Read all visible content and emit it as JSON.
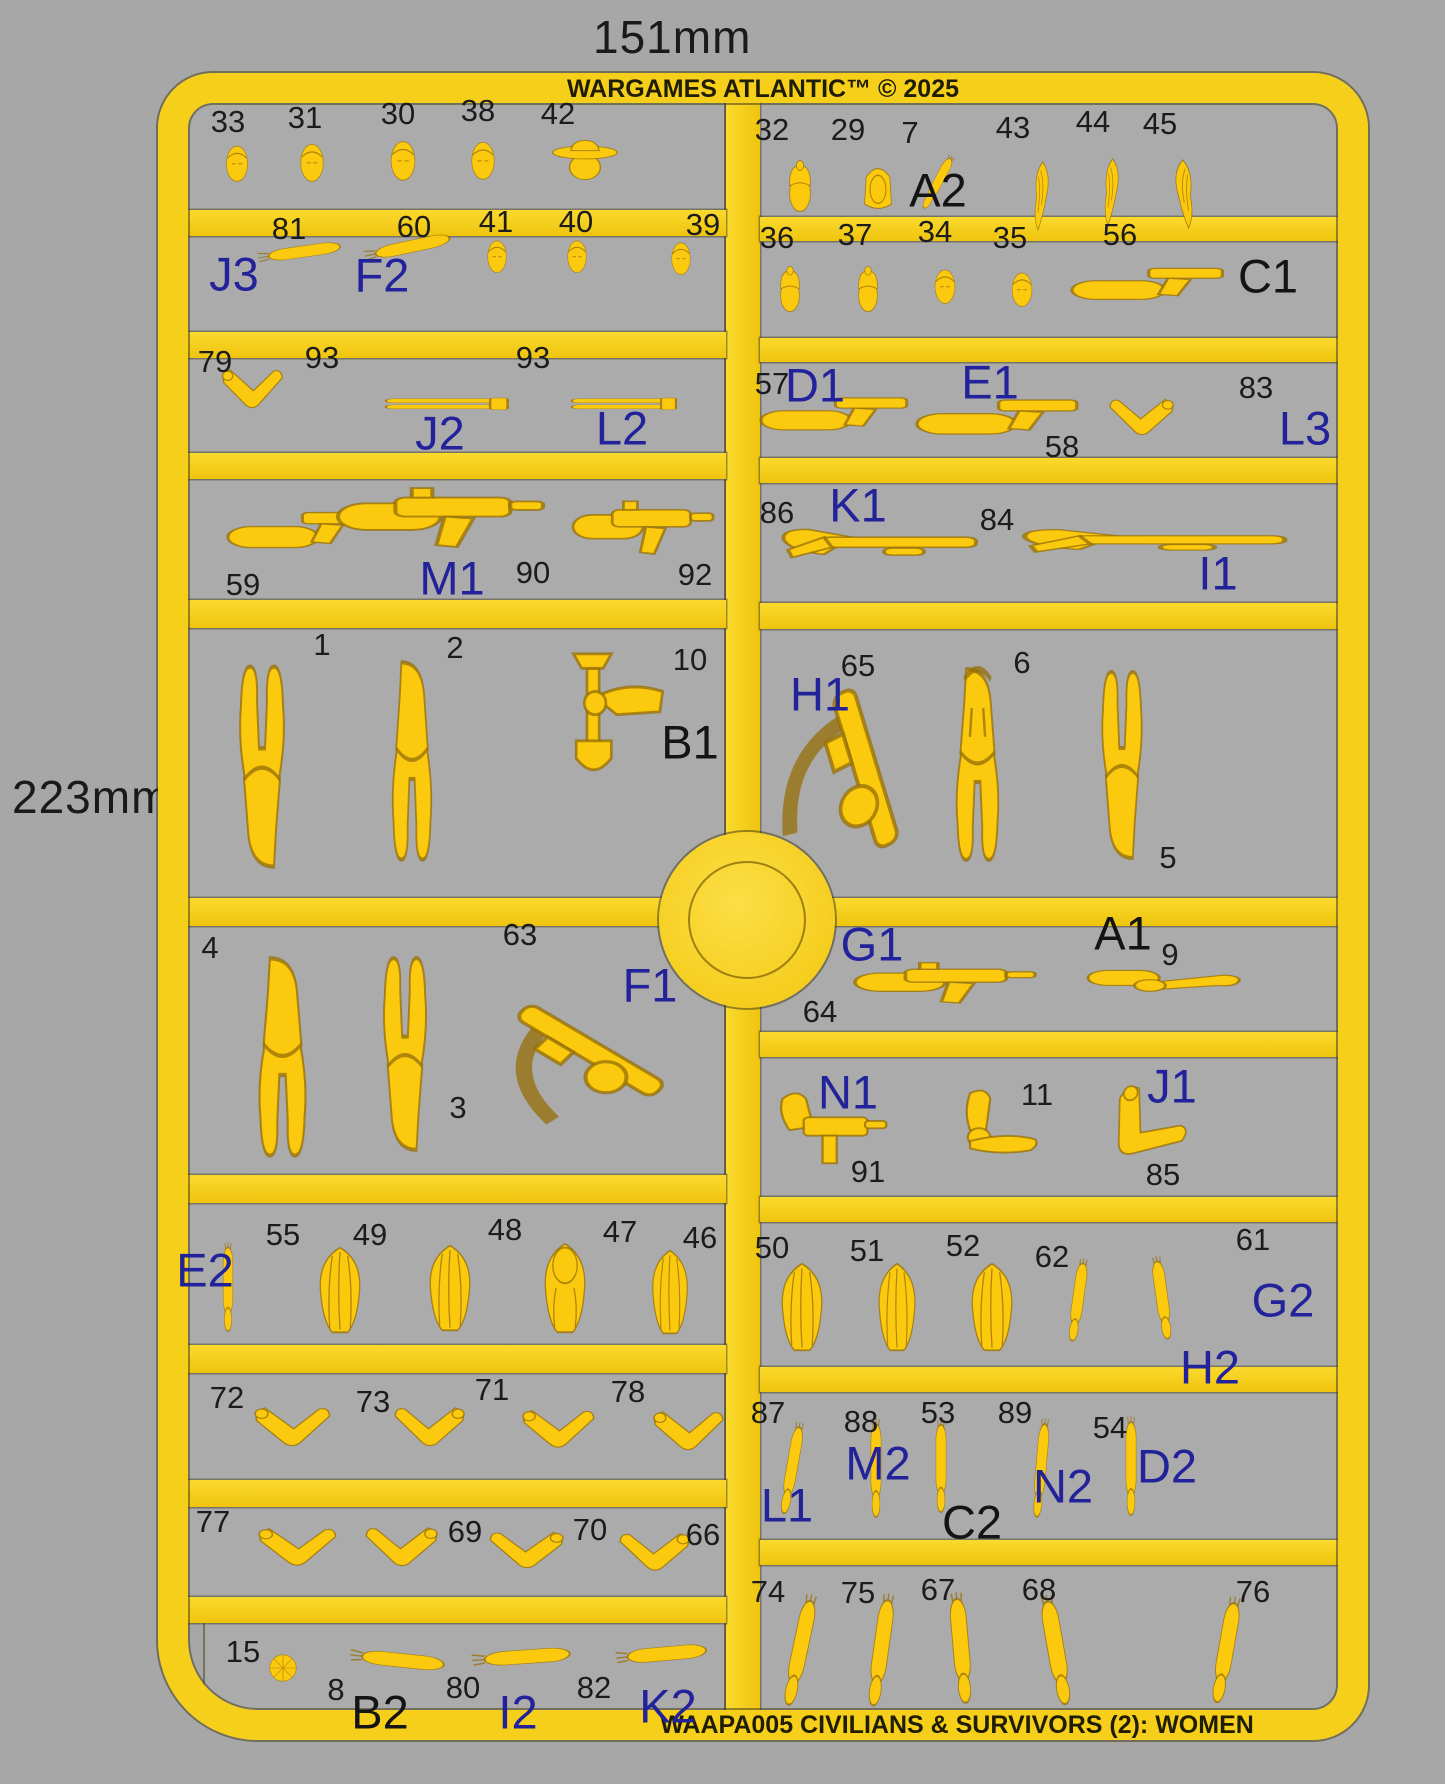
{
  "meta": {
    "width_label": "151mm",
    "height_label": "223mm",
    "brand": "WARGAMES ATLANTIC™ © 2025",
    "product": "WAAPA005 CIVILIANS & SURVIVORS (2): WOMEN"
  },
  "colors": {
    "background": "#a7a7a7",
    "sprue_yellow": "#f6cf1a",
    "part_yellow": "#fbc90d",
    "group_blue": "#22229a",
    "text_black": "#1c1c1c"
  },
  "labels": [
    {
      "t": "33",
      "x": 228,
      "y": 122,
      "k": "num"
    },
    {
      "t": "31",
      "x": 305,
      "y": 118,
      "k": "num"
    },
    {
      "t": "30",
      "x": 398,
      "y": 114,
      "k": "num"
    },
    {
      "t": "38",
      "x": 478,
      "y": 111,
      "k": "num"
    },
    {
      "t": "42",
      "x": 558,
      "y": 114,
      "k": "num"
    },
    {
      "t": "81",
      "x": 289,
      "y": 229,
      "k": "num"
    },
    {
      "t": "60",
      "x": 414,
      "y": 227,
      "k": "num"
    },
    {
      "t": "41",
      "x": 496,
      "y": 222,
      "k": "num"
    },
    {
      "t": "40",
      "x": 576,
      "y": 222,
      "k": "num"
    },
    {
      "t": "39",
      "x": 703,
      "y": 225,
      "k": "num"
    },
    {
      "t": "J3",
      "x": 234,
      "y": 274,
      "k": "blue"
    },
    {
      "t": "F2",
      "x": 382,
      "y": 275,
      "k": "blue"
    },
    {
      "t": "79",
      "x": 215,
      "y": 362,
      "k": "num"
    },
    {
      "t": "93",
      "x": 322,
      "y": 358,
      "k": "num"
    },
    {
      "t": "93",
      "x": 533,
      "y": 358,
      "k": "num"
    },
    {
      "t": "J2",
      "x": 440,
      "y": 433,
      "k": "blue"
    },
    {
      "t": "L2",
      "x": 622,
      "y": 428,
      "k": "blue"
    },
    {
      "t": "59",
      "x": 243,
      "y": 585,
      "k": "num"
    },
    {
      "t": "90",
      "x": 533,
      "y": 573,
      "k": "num"
    },
    {
      "t": "92",
      "x": 695,
      "y": 575,
      "k": "num"
    },
    {
      "t": "M1",
      "x": 452,
      "y": 578,
      "k": "blue"
    },
    {
      "t": "1",
      "x": 322,
      "y": 645,
      "k": "num"
    },
    {
      "t": "2",
      "x": 455,
      "y": 648,
      "k": "num"
    },
    {
      "t": "10",
      "x": 690,
      "y": 660,
      "k": "num"
    },
    {
      "t": "B1",
      "x": 690,
      "y": 742,
      "k": "black"
    },
    {
      "t": "4",
      "x": 210,
      "y": 948,
      "k": "num"
    },
    {
      "t": "3",
      "x": 458,
      "y": 1108,
      "k": "num"
    },
    {
      "t": "63",
      "x": 520,
      "y": 935,
      "k": "num"
    },
    {
      "t": "F1",
      "x": 650,
      "y": 985,
      "k": "blue"
    },
    {
      "t": "E2",
      "x": 205,
      "y": 1270,
      "k": "blue"
    },
    {
      "t": "55",
      "x": 283,
      "y": 1235,
      "k": "num"
    },
    {
      "t": "49",
      "x": 370,
      "y": 1235,
      "k": "num"
    },
    {
      "t": "48",
      "x": 505,
      "y": 1230,
      "k": "num"
    },
    {
      "t": "47",
      "x": 620,
      "y": 1232,
      "k": "num"
    },
    {
      "t": "46",
      "x": 700,
      "y": 1238,
      "k": "num"
    },
    {
      "t": "72",
      "x": 227,
      "y": 1398,
      "k": "num"
    },
    {
      "t": "73",
      "x": 373,
      "y": 1402,
      "k": "num"
    },
    {
      "t": "71",
      "x": 492,
      "y": 1390,
      "k": "num"
    },
    {
      "t": "78",
      "x": 628,
      "y": 1392,
      "k": "num"
    },
    {
      "t": "77",
      "x": 213,
      "y": 1522,
      "k": "num"
    },
    {
      "t": "69",
      "x": 465,
      "y": 1532,
      "k": "num"
    },
    {
      "t": "70",
      "x": 590,
      "y": 1530,
      "k": "num"
    },
    {
      "t": "66",
      "x": 703,
      "y": 1535,
      "k": "num"
    },
    {
      "t": "15",
      "x": 243,
      "y": 1652,
      "k": "num"
    },
    {
      "t": "8",
      "x": 336,
      "y": 1690,
      "k": "num"
    },
    {
      "t": "80",
      "x": 463,
      "y": 1688,
      "k": "num"
    },
    {
      "t": "82",
      "x": 594,
      "y": 1688,
      "k": "num"
    },
    {
      "t": "B2",
      "x": 380,
      "y": 1712,
      "k": "black"
    },
    {
      "t": "I2",
      "x": 518,
      "y": 1712,
      "k": "blue"
    },
    {
      "t": "K2",
      "x": 668,
      "y": 1706,
      "k": "blue"
    },
    {
      "t": "32",
      "x": 772,
      "y": 130,
      "k": "num"
    },
    {
      "t": "29",
      "x": 848,
      "y": 130,
      "k": "num"
    },
    {
      "t": "7",
      "x": 910,
      "y": 133,
      "k": "num"
    },
    {
      "t": "43",
      "x": 1013,
      "y": 128,
      "k": "num"
    },
    {
      "t": "44",
      "x": 1093,
      "y": 122,
      "k": "num"
    },
    {
      "t": "45",
      "x": 1160,
      "y": 124,
      "k": "num"
    },
    {
      "t": "A2",
      "x": 938,
      "y": 190,
      "k": "black"
    },
    {
      "t": "36",
      "x": 777,
      "y": 238,
      "k": "num"
    },
    {
      "t": "37",
      "x": 855,
      "y": 235,
      "k": "num"
    },
    {
      "t": "34",
      "x": 935,
      "y": 232,
      "k": "num"
    },
    {
      "t": "35",
      "x": 1010,
      "y": 238,
      "k": "num"
    },
    {
      "t": "56",
      "x": 1120,
      "y": 235,
      "k": "num"
    },
    {
      "t": "C1",
      "x": 1268,
      "y": 276,
      "k": "black"
    },
    {
      "t": "57",
      "x": 772,
      "y": 384,
      "k": "num"
    },
    {
      "t": "D1",
      "x": 815,
      "y": 385,
      "k": "blue"
    },
    {
      "t": "E1",
      "x": 990,
      "y": 382,
      "k": "blue"
    },
    {
      "t": "58",
      "x": 1062,
      "y": 447,
      "k": "num"
    },
    {
      "t": "83",
      "x": 1256,
      "y": 388,
      "k": "num"
    },
    {
      "t": "L3",
      "x": 1305,
      "y": 428,
      "k": "blue"
    },
    {
      "t": "86",
      "x": 777,
      "y": 513,
      "k": "num"
    },
    {
      "t": "K1",
      "x": 858,
      "y": 505,
      "k": "blue"
    },
    {
      "t": "84",
      "x": 997,
      "y": 520,
      "k": "num"
    },
    {
      "t": "I1",
      "x": 1218,
      "y": 573,
      "k": "blue"
    },
    {
      "t": "H1",
      "x": 820,
      "y": 694,
      "k": "blue"
    },
    {
      "t": "65",
      "x": 858,
      "y": 666,
      "k": "num"
    },
    {
      "t": "6",
      "x": 1022,
      "y": 663,
      "k": "num"
    },
    {
      "t": "5",
      "x": 1168,
      "y": 858,
      "k": "num"
    },
    {
      "t": "G1",
      "x": 872,
      "y": 944,
      "k": "blue"
    },
    {
      "t": "64",
      "x": 820,
      "y": 1012,
      "k": "num"
    },
    {
      "t": "A1",
      "x": 1123,
      "y": 933,
      "k": "black"
    },
    {
      "t": "9",
      "x": 1170,
      "y": 955,
      "k": "num"
    },
    {
      "t": "N1",
      "x": 848,
      "y": 1092,
      "k": "blue"
    },
    {
      "t": "91",
      "x": 868,
      "y": 1172,
      "k": "num"
    },
    {
      "t": "11",
      "x": 1037,
      "y": 1095,
      "k": "num"
    },
    {
      "t": "J1",
      "x": 1172,
      "y": 1086,
      "k": "blue"
    },
    {
      "t": "85",
      "x": 1163,
      "y": 1175,
      "k": "num"
    },
    {
      "t": "50",
      "x": 772,
      "y": 1248,
      "k": "num"
    },
    {
      "t": "51",
      "x": 867,
      "y": 1251,
      "k": "num"
    },
    {
      "t": "52",
      "x": 963,
      "y": 1246,
      "k": "num"
    },
    {
      "t": "62",
      "x": 1052,
      "y": 1257,
      "k": "num"
    },
    {
      "t": "61",
      "x": 1253,
      "y": 1240,
      "k": "num"
    },
    {
      "t": "H2",
      "x": 1210,
      "y": 1367,
      "k": "blue"
    },
    {
      "t": "G2",
      "x": 1283,
      "y": 1300,
      "k": "blue"
    },
    {
      "t": "87",
      "x": 768,
      "y": 1413,
      "k": "num"
    },
    {
      "t": "88",
      "x": 861,
      "y": 1422,
      "k": "num"
    },
    {
      "t": "53",
      "x": 938,
      "y": 1413,
      "k": "num"
    },
    {
      "t": "89",
      "x": 1015,
      "y": 1413,
      "k": "num"
    },
    {
      "t": "54",
      "x": 1110,
      "y": 1428,
      "k": "num"
    },
    {
      "t": "L1",
      "x": 787,
      "y": 1505,
      "k": "blue"
    },
    {
      "t": "M2",
      "x": 878,
      "y": 1463,
      "k": "blue"
    },
    {
      "t": "C2",
      "x": 972,
      "y": 1522,
      "k": "black"
    },
    {
      "t": "N2",
      "x": 1063,
      "y": 1486,
      "k": "blue"
    },
    {
      "t": "D2",
      "x": 1167,
      "y": 1466,
      "k": "blue"
    },
    {
      "t": "74",
      "x": 768,
      "y": 1592,
      "k": "num"
    },
    {
      "t": "75",
      "x": 858,
      "y": 1593,
      "k": "num"
    },
    {
      "t": "67",
      "x": 938,
      "y": 1590,
      "k": "num"
    },
    {
      "t": "68",
      "x": 1039,
      "y": 1590,
      "k": "num"
    },
    {
      "t": "76",
      "x": 1253,
      "y": 1592,
      "k": "num"
    }
  ],
  "parts": [
    {
      "id": "33",
      "s": "head",
      "x": 237,
      "y": 163,
      "w": 32,
      "h": 40
    },
    {
      "id": "31",
      "s": "head",
      "x": 312,
      "y": 162,
      "w": 34,
      "h": 42
    },
    {
      "id": "30",
      "s": "head",
      "x": 403,
      "y": 160,
      "w": 36,
      "h": 44
    },
    {
      "id": "38",
      "s": "head",
      "x": 483,
      "y": 160,
      "w": 34,
      "h": 42
    },
    {
      "id": "42",
      "s": "headHat",
      "x": 585,
      "y": 158,
      "w": 70,
      "h": 46
    },
    {
      "id": "81",
      "s": "armS",
      "x": 300,
      "y": 252,
      "w": 88,
      "h": 28,
      "r": -8
    },
    {
      "id": "60",
      "s": "armS",
      "x": 408,
      "y": 247,
      "w": 92,
      "h": 30,
      "r": -12
    },
    {
      "id": "41",
      "s": "head",
      "x": 497,
      "y": 256,
      "w": 28,
      "h": 36
    },
    {
      "id": "40",
      "s": "head",
      "x": 577,
      "y": 256,
      "w": 28,
      "h": 36
    },
    {
      "id": "39",
      "s": "head",
      "x": 681,
      "y": 258,
      "w": 28,
      "h": 36
    },
    {
      "id": "79",
      "s": "armB",
      "x": 252,
      "y": 392,
      "w": 64,
      "h": 58
    },
    {
      "id": "93a",
      "s": "barrel",
      "x": 448,
      "y": 404,
      "w": 124,
      "h": 20
    },
    {
      "id": "93b",
      "s": "barrel",
      "x": 625,
      "y": 404,
      "w": 106,
      "h": 20
    },
    {
      "id": "59",
      "s": "pistolArm",
      "x": 305,
      "y": 528,
      "w": 155,
      "h": 70
    },
    {
      "id": "90",
      "s": "smgArm",
      "x": 440,
      "y": 518,
      "w": 205,
      "h": 95
    },
    {
      "id": "92",
      "s": "smgArm",
      "x": 643,
      "y": 528,
      "w": 140,
      "h": 85
    },
    {
      "id": "1",
      "s": "bodyInv",
      "x": 262,
      "y": 765,
      "w": 100,
      "h": 215
    },
    {
      "id": "2",
      "s": "body",
      "x": 412,
      "y": 762,
      "w": 88,
      "h": 212
    },
    {
      "id": "10",
      "s": "shovelArm",
      "x": 600,
      "y": 720,
      "w": 135,
      "h": 145
    },
    {
      "id": "4",
      "s": "body",
      "x": 282,
      "y": 1058,
      "w": 105,
      "h": 212
    },
    {
      "id": "3",
      "s": "bodyInv",
      "x": 405,
      "y": 1053,
      "w": 96,
      "h": 206
    },
    {
      "id": "63",
      "s": "rifleSling",
      "x": 585,
      "y": 1055,
      "w": 205,
      "h": 155
    },
    {
      "id": "55",
      "s": "armV",
      "x": 228,
      "y": 1287,
      "w": 28,
      "h": 90
    },
    {
      "id": "49",
      "s": "hair",
      "x": 340,
      "y": 1290,
      "w": 64,
      "h": 90
    },
    {
      "id": "48",
      "s": "hair",
      "x": 450,
      "y": 1288,
      "w": 64,
      "h": 90
    },
    {
      "id": "47",
      "s": "hairCap",
      "x": 565,
      "y": 1288,
      "w": 64,
      "h": 94
    },
    {
      "id": "46",
      "s": "hair",
      "x": 670,
      "y": 1292,
      "w": 56,
      "h": 88
    },
    {
      "id": "72",
      "s": "armB",
      "x": 292,
      "y": 1430,
      "w": 80,
      "h": 58
    },
    {
      "id": "73",
      "s": "armB",
      "x": 430,
      "y": 1430,
      "w": 74,
      "h": 58,
      "f": 1
    },
    {
      "id": "71",
      "s": "armB",
      "x": 558,
      "y": 1432,
      "w": 76,
      "h": 56
    },
    {
      "id": "78",
      "s": "armB",
      "x": 688,
      "y": 1434,
      "w": 74,
      "h": 58
    },
    {
      "id": "77",
      "s": "armB",
      "x": 297,
      "y": 1550,
      "w": 82,
      "h": 56
    },
    {
      "id": "69",
      "s": "armB",
      "x": 402,
      "y": 1550,
      "w": 76,
      "h": 58,
      "f": 1
    },
    {
      "id": "70",
      "s": "armB",
      "x": 527,
      "y": 1553,
      "w": 78,
      "h": 54,
      "f": 1
    },
    {
      "id": "66",
      "s": "armB",
      "x": 655,
      "y": 1555,
      "w": 74,
      "h": 56,
      "f": 1
    },
    {
      "id": "15",
      "s": "bun",
      "x": 283,
      "y": 1668,
      "w": 30,
      "h": 30
    },
    {
      "id": "8",
      "s": "armS",
      "x": 398,
      "y": 1660,
      "w": 100,
      "h": 34,
      "r": 6
    },
    {
      "id": "80",
      "s": "armS",
      "x": 522,
      "y": 1657,
      "w": 104,
      "h": 34,
      "r": -4
    },
    {
      "id": "82",
      "s": "armS",
      "x": 662,
      "y": 1654,
      "w": 96,
      "h": 34,
      "r": -5
    },
    {
      "id": "32",
      "s": "headBeanie",
      "x": 800,
      "y": 186,
      "w": 40,
      "h": 54
    },
    {
      "id": "29",
      "s": "headHood",
      "x": 878,
      "y": 186,
      "w": 42,
      "h": 56
    },
    {
      "id": "7",
      "s": "armV",
      "x": 938,
      "y": 182,
      "w": 26,
      "h": 60,
      "r": 28
    },
    {
      "id": "43",
      "s": "pony",
      "x": 1040,
      "y": 196,
      "w": 34,
      "h": 74
    },
    {
      "id": "44",
      "s": "pony",
      "x": 1110,
      "y": 192,
      "w": 34,
      "h": 72
    },
    {
      "id": "45",
      "s": "pony",
      "x": 1186,
      "y": 194,
      "w": 42,
      "h": 74,
      "f": 1
    },
    {
      "id": "36",
      "s": "headBeanie",
      "x": 790,
      "y": 289,
      "w": 36,
      "h": 48
    },
    {
      "id": "37",
      "s": "headBeanie",
      "x": 868,
      "y": 289,
      "w": 36,
      "h": 48
    },
    {
      "id": "34",
      "s": "head",
      "x": 945,
      "y": 286,
      "w": 30,
      "h": 38
    },
    {
      "id": "35",
      "s": "head",
      "x": 1022,
      "y": 289,
      "w": 30,
      "h": 38
    },
    {
      "id": "56",
      "s": "pistolArm",
      "x": 1152,
      "y": 282,
      "w": 160,
      "h": 62
    },
    {
      "id": "57",
      "s": "pistolArm",
      "x": 838,
      "y": 412,
      "w": 155,
      "h": 64
    },
    {
      "id": "58",
      "s": "pistolArm",
      "x": 1002,
      "y": 415,
      "w": 170,
      "h": 68
    },
    {
      "id": "83",
      "s": "armB",
      "x": 1142,
      "y": 420,
      "w": 68,
      "h": 54,
      "f": 1
    },
    {
      "id": "86",
      "s": "shotgunArm",
      "x": 880,
      "y": 545,
      "w": 200,
      "h": 78
    },
    {
      "id": "84",
      "s": "shotgunArm",
      "x": 1155,
      "y": 542,
      "w": 270,
      "h": 62
    },
    {
      "id": "65",
      "s": "rifleSling",
      "x": 858,
      "y": 772,
      "w": 175,
      "h": 210,
      "r": 30
    },
    {
      "id": "6",
      "s": "bodyHoodie",
      "x": 977,
      "y": 765,
      "w": 95,
      "h": 205
    },
    {
      "id": "5",
      "s": "bodyInv",
      "x": 1122,
      "y": 764,
      "w": 90,
      "h": 200
    },
    {
      "id": "64",
      "s": "smgArm",
      "x": 945,
      "y": 983,
      "w": 180,
      "h": 65
    },
    {
      "id": "9",
      "s": "batArm",
      "x": 1165,
      "y": 982,
      "w": 155,
      "h": 58
    },
    {
      "id": "91",
      "s": "uziArm",
      "x": 832,
      "y": 1132,
      "w": 118,
      "h": 92
    },
    {
      "id": "11",
      "s": "macheteArm",
      "x": 988,
      "y": 1130,
      "w": 112,
      "h": 92
    },
    {
      "id": "85",
      "s": "armB",
      "x": 1138,
      "y": 1133,
      "w": 82,
      "h": 92,
      "r": 40
    },
    {
      "id": "50",
      "s": "hair",
      "x": 802,
      "y": 1307,
      "w": 64,
      "h": 92
    },
    {
      "id": "51",
      "s": "hair",
      "x": 897,
      "y": 1307,
      "w": 58,
      "h": 92
    },
    {
      "id": "52",
      "s": "hair",
      "x": 992,
      "y": 1307,
      "w": 64,
      "h": 92
    },
    {
      "id": "62",
      "s": "armV",
      "x": 1078,
      "y": 1300,
      "w": 32,
      "h": 84,
      "r": 8
    },
    {
      "id": "61",
      "s": "armV",
      "x": 1162,
      "y": 1298,
      "w": 34,
      "h": 84,
      "r": -8
    },
    {
      "id": "87",
      "s": "armV",
      "x": 792,
      "y": 1468,
      "w": 32,
      "h": 94,
      "r": 10
    },
    {
      "id": "88",
      "s": "armV",
      "x": 876,
      "y": 1468,
      "w": 30,
      "h": 100
    },
    {
      "id": "53",
      "s": "armV",
      "x": 941,
      "y": 1466,
      "w": 30,
      "h": 94
    },
    {
      "id": "89",
      "s": "armV",
      "x": 1041,
      "y": 1468,
      "w": 30,
      "h": 100,
      "r": 5
    },
    {
      "id": "54",
      "s": "armV",
      "x": 1131,
      "y": 1466,
      "w": 30,
      "h": 100
    },
    {
      "id": "74",
      "s": "armV",
      "x": 800,
      "y": 1650,
      "w": 44,
      "h": 114,
      "r": 12
    },
    {
      "id": "75",
      "s": "armV",
      "x": 881,
      "y": 1650,
      "w": 44,
      "h": 114,
      "r": 8
    },
    {
      "id": "67",
      "s": "armV",
      "x": 961,
      "y": 1648,
      "w": 46,
      "h": 112,
      "r": -5
    },
    {
      "id": "68",
      "s": "armV",
      "x": 1056,
      "y": 1650,
      "w": 48,
      "h": 112,
      "r": -10
    },
    {
      "id": "76",
      "s": "armV",
      "x": 1226,
      "y": 1650,
      "w": 44,
      "h": 108,
      "r": 10
    }
  ]
}
